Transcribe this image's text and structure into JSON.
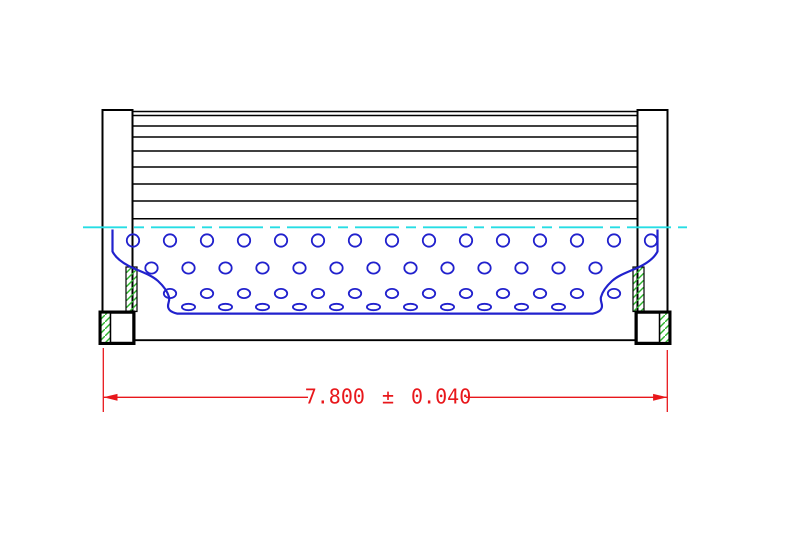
{
  "title": "Filter element cross-section technical drawing",
  "dimension": {
    "label": "7.800 ± 0.040",
    "nominal": "7.800",
    "tolerance": "0.040"
  },
  "colors": {
    "background": "#ffffff",
    "outline": "#000000",
    "core": "#2121cd",
    "centerline": "#26dde4",
    "dimension": "#e8171b",
    "hatch": "#2db52d"
  },
  "pleats": {
    "x_start": 132.5,
    "x_end": 637.5,
    "line_ys": [
      111.5,
      115.5,
      126,
      137,
      151,
      167,
      184,
      201,
      218.8
    ]
  },
  "perforations": {
    "spacing": 37,
    "rows": [
      {
        "y": 240.5,
        "rx": 6.2,
        "ry": 6.2,
        "x0": 133,
        "count": 15
      },
      {
        "y": 268,
        "rx": 6.2,
        "ry": 5.6,
        "x0": 151.5,
        "count": 13
      },
      {
        "y": 293.5,
        "rx": 6.2,
        "ry": 4.6,
        "x0": 170,
        "count": 13
      },
      {
        "y": 307,
        "rx": 6.6,
        "ry": 3.2,
        "x0": 188.5,
        "count": 11
      }
    ]
  }
}
